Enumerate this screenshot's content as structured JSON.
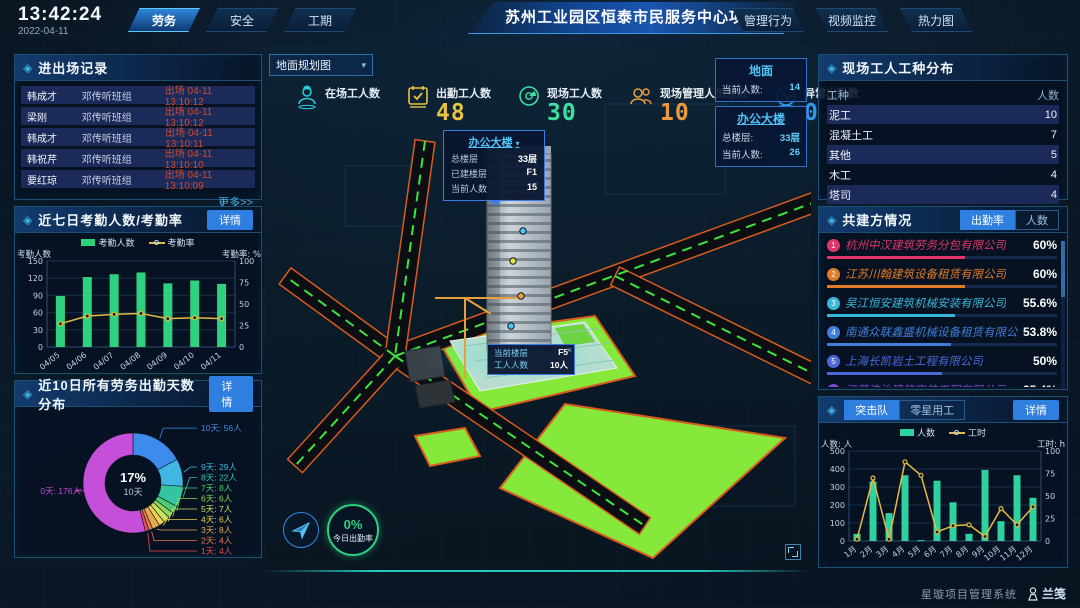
{
  "icons": {
    "diamond": "◈",
    "caret": "▾",
    "close": "×"
  },
  "colors": {
    "accent": "#2f7fe0",
    "bar_green": "#2ed17e",
    "line_yellow": "#e3bc3f",
    "alert_red": "#d04b30",
    "link_cyan": "#45b5e8",
    "lawn_green": "#86e83a",
    "road_orange": "#d85c1e"
  },
  "header": {
    "time": "13:42:24",
    "date": "2022-04-11",
    "left_tabs": [
      {
        "label": "劳务",
        "active": true
      },
      {
        "label": "安全",
        "active": false
      },
      {
        "label": "工期",
        "active": false
      }
    ],
    "title": "苏州工业园区恒泰市民服务中心项目",
    "right_tabs": [
      {
        "label": "管理行为"
      },
      {
        "label": "视频监控"
      },
      {
        "label": "热力图"
      }
    ]
  },
  "entry_exit": {
    "title": "进出场记录",
    "more_label": "更多>>",
    "rows": [
      {
        "name": "韩成才",
        "team": "邓传听班组",
        "event": "出场 04-11 13:10:12"
      },
      {
        "name": "梁刚",
        "team": "邓传听班组",
        "event": "出场 04-11 13:10:12"
      },
      {
        "name": "韩成才",
        "team": "邓传听班组",
        "event": "出场 04-11 13:10:11"
      },
      {
        "name": "韩祝芹",
        "team": "邓传听班组",
        "event": "出场 04-11 13:10:10"
      },
      {
        "name": "要红琼",
        "team": "邓传听班组",
        "event": "出场 04-11 13:10:09"
      }
    ]
  },
  "attendance_panel": {
    "title": "近七日考勤人数/考勤率",
    "detail_label": "详情"
  },
  "distribution_panel": {
    "title": "近10日所有劳务出勤天数分布",
    "detail_label": "详情"
  },
  "worker_types": {
    "title": "现场工人工种分布",
    "columns": [
      "工种",
      "人数"
    ],
    "rows": [
      {
        "type": "泥工",
        "count": "10"
      },
      {
        "type": "混凝土工",
        "count": "7"
      },
      {
        "type": "其他",
        "count": "5"
      },
      {
        "type": "木工",
        "count": "4"
      },
      {
        "type": "塔司",
        "count": "4"
      }
    ]
  },
  "partners": {
    "title": "共建方情况",
    "tabs": [
      {
        "label": "出勤率",
        "active": true
      },
      {
        "label": "人数",
        "active": false
      }
    ],
    "items": [
      {
        "rank": "1",
        "name": "杭州中汉建筑劳务分包有限公司",
        "value": "60%",
        "pct": 60,
        "color": "#e0356a"
      },
      {
        "rank": "2",
        "name": "江苏川翰建筑设备租赁有限公司",
        "value": "60%",
        "pct": 60,
        "color": "#e07b2a"
      },
      {
        "rank": "3",
        "name": "吴江恒安建筑机械安装有限公司",
        "value": "55.6%",
        "pct": 55.6,
        "color": "#38b8d8"
      },
      {
        "rank": "4",
        "name": "南通众联鑫盛机械设备租赁有限公司",
        "value": "53.8%",
        "pct": 53.8,
        "color": "#3f7fd8"
      },
      {
        "rank": "5",
        "name": "上海长凯岩土工程有限公司",
        "value": "50%",
        "pct": 50,
        "color": "#4a68d8"
      },
      {
        "rank": "6",
        "name": "江苏浩治建筑安装工程有限公司",
        "value": "35.4%",
        "pct": 35.4,
        "color": "#7a4ad0"
      }
    ]
  },
  "assault_panel": {
    "tabs": [
      {
        "label": "突击队",
        "active": true
      },
      {
        "label": "零星用工",
        "active": false
      }
    ],
    "detail_label": "详情"
  },
  "map": {
    "layer_select": "地面规划图",
    "stats": [
      {
        "label": "在场工人数",
        "value": "",
        "icon": "worker-icon",
        "color": "#2ec8dc"
      },
      {
        "label": "出勤工人数",
        "value": "48",
        "icon": "calendar-icon",
        "color": "#e8c341"
      },
      {
        "label": "现场工人数",
        "value": "30",
        "icon": "dial-icon",
        "color": "#3ce0a0"
      },
      {
        "label": "现场管理人员总数",
        "value": "10",
        "icon": "people-icon",
        "color": "#e89a3c"
      },
      {
        "label": "异常出勤数",
        "value": "0",
        "icon": "pulse-icon",
        "color": "#2e9ae8"
      }
    ],
    "building_popup": {
      "title": "办公大楼",
      "rows": [
        {
          "label": "总楼层",
          "value": "33层"
        },
        {
          "label": "已建楼层",
          "value": "F1"
        },
        {
          "label": "当前人数",
          "value": "15"
        }
      ]
    },
    "floor_tooltip": {
      "rows": [
        {
          "label": "当前楼层",
          "value": "F5"
        },
        {
          "label": "工人人数",
          "value": "10人"
        }
      ]
    },
    "overlay_cards": [
      {
        "title": "地面",
        "rows": [
          {
            "label": "当前人数:",
            "value": "14"
          }
        ]
      },
      {
        "title": "办公大楼",
        "rows": [
          {
            "label": "总楼层:",
            "value": "33层"
          },
          {
            "label": "当前人数:",
            "value": "26"
          }
        ]
      }
    ],
    "attendance_badge": {
      "value": "0%",
      "label": "今日出勤率"
    }
  },
  "footer": {
    "system_name": "星璇项目管理系统",
    "logo": "兰笺"
  },
  "chart_data": [
    {
      "id": "attendance",
      "type": "bar",
      "title": "近七日考勤人数/考勤率",
      "categories": [
        "04/05",
        "04/06",
        "04/07",
        "04/08",
        "04/09",
        "04/10",
        "04/11"
      ],
      "series": [
        {
          "name": "考勤人数",
          "type": "bar",
          "color": "#2ed17e",
          "values": [
            89,
            122,
            127,
            130,
            111,
            116,
            110
          ]
        },
        {
          "name": "考勤率",
          "type": "line",
          "color": "#e3bc3f",
          "axis": "right",
          "values": [
            27,
            36,
            38,
            39,
            33,
            34,
            33
          ]
        }
      ],
      "ylabel_left": "考勤人数",
      "ylabel_right": "考勤率: %",
      "ylim_left": [
        0,
        150
      ],
      "ylim_right": [
        0,
        100
      ],
      "yticks_left": [
        0,
        30,
        60,
        90,
        120,
        150
      ],
      "yticks_right": [
        0,
        25,
        50,
        75,
        100
      ],
      "legend_position": "top",
      "grid": true
    },
    {
      "id": "distribution",
      "type": "pie",
      "title": "近10日所有劳务出勤天数分布",
      "center_label": {
        "pct": "17%",
        "name": "10天"
      },
      "slices": [
        {
          "label": "10天",
          "count": "56人",
          "value": 56,
          "color": "#3d8bea"
        },
        {
          "label": "9天",
          "count": "29人",
          "value": 29,
          "color": "#41b6e3"
        },
        {
          "label": "8天",
          "count": "22人",
          "value": 22,
          "color": "#35c4a2"
        },
        {
          "label": "7天",
          "count": "8人",
          "value": 8,
          "color": "#4ecb73"
        },
        {
          "label": "6天",
          "count": "6人",
          "value": 6,
          "color": "#8ed957"
        },
        {
          "label": "5天",
          "count": "7人",
          "value": 7,
          "color": "#c9e25b"
        },
        {
          "label": "4天",
          "count": "6人",
          "value": 6,
          "color": "#ead34f"
        },
        {
          "label": "3天",
          "count": "8人",
          "value": 8,
          "color": "#e8a94e"
        },
        {
          "label": "2天",
          "count": "4人",
          "value": 4,
          "color": "#e87b52"
        },
        {
          "label": "1天",
          "count": "4人",
          "value": 4,
          "color": "#e84c4c"
        },
        {
          "label": "0天",
          "count": "176人",
          "value": 176,
          "color": "#c54fd8"
        }
      ]
    },
    {
      "id": "assault",
      "type": "bar",
      "title": "突击队",
      "categories": [
        "1月",
        "2月",
        "3月",
        "4月",
        "5月",
        "6月",
        "7月",
        "8月",
        "9月",
        "10月",
        "11月",
        "12月"
      ],
      "series": [
        {
          "name": "人数",
          "type": "bar",
          "color": "#2ed1a0",
          "values": [
            40,
            330,
            155,
            365,
            5,
            335,
            215,
            40,
            395,
            110,
            365,
            240
          ]
        },
        {
          "name": "工时",
          "type": "line",
          "color": "#e3bc3f",
          "axis": "right",
          "values": [
            2,
            70,
            2,
            88,
            73,
            10,
            17,
            18,
            5,
            36,
            18,
            38
          ]
        }
      ],
      "ylabel_left": "人数: 人",
      "ylabel_right": "工时: h",
      "ylim_left": [
        0,
        500
      ],
      "ylim_right": [
        0,
        100
      ],
      "yticks_left": [
        0,
        100,
        200,
        300,
        400,
        500
      ],
      "yticks_right": [
        0,
        25,
        50,
        75,
        100
      ],
      "legend_position": "top",
      "grid": true
    }
  ]
}
